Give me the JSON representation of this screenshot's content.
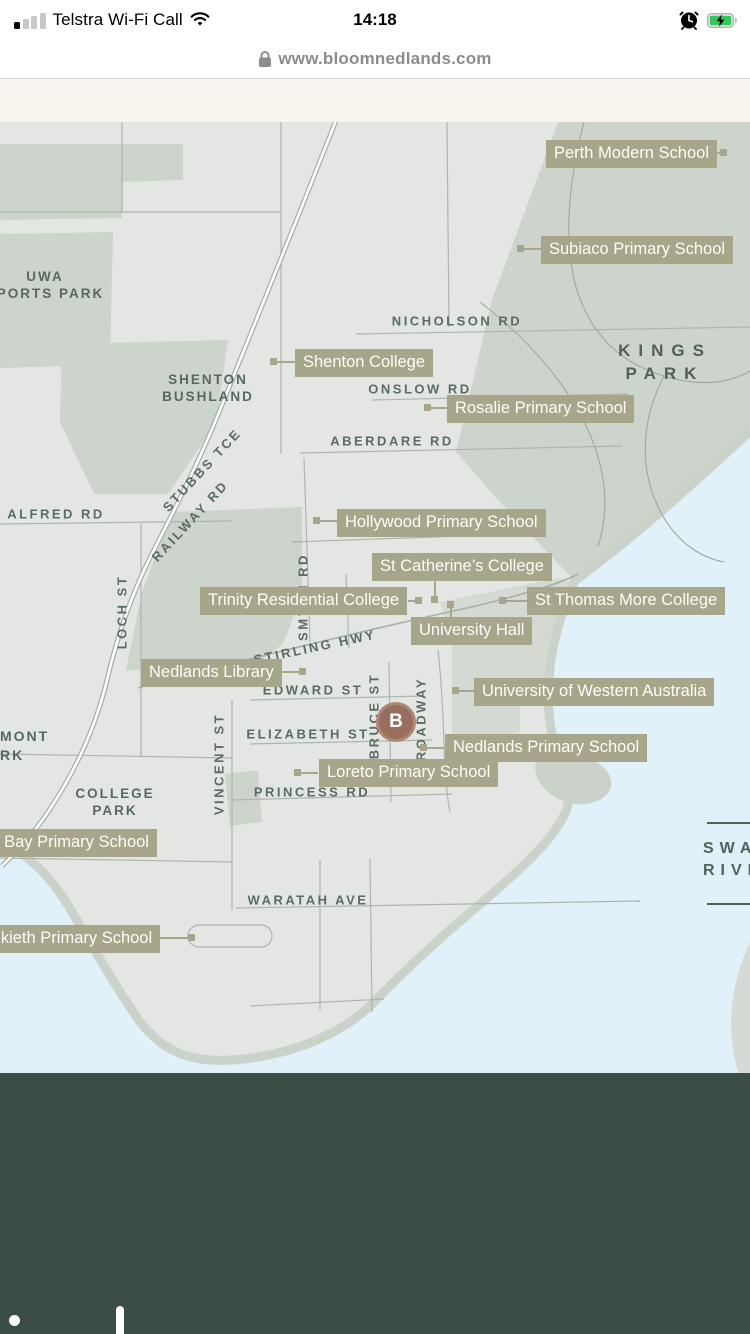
{
  "status_bar": {
    "carrier": "Telstra Wi-Fi Call",
    "time": "14:18"
  },
  "url_bar": {
    "url": "www.bloomnedlands.com"
  },
  "map": {
    "marker_b": "B",
    "poi": [
      {
        "label": "Perth Modern School"
      },
      {
        "label": "Subiaco Primary School"
      },
      {
        "label": "Shenton College"
      },
      {
        "label": "Rosalie Primary School"
      },
      {
        "label": "Hollywood Primary School"
      },
      {
        "label": "St Catherine’s College"
      },
      {
        "label": "Trinity Residential College"
      },
      {
        "label": "St Thomas More College"
      },
      {
        "label": "University Hall"
      },
      {
        "label": "Nedlands Library"
      },
      {
        "label": "University of Western Australia"
      },
      {
        "label": "Nedlands Primary School"
      },
      {
        "label": "Loreto Primary School"
      },
      {
        "label": "r Bay Primary School"
      },
      {
        "label": "alkieth Primary School"
      }
    ],
    "streets": {
      "nicholson": "NICHOLSON RD",
      "onslow": "ONSLOW RD",
      "aberdare": "ABERDARE RD",
      "alfred": "ALFRED RD",
      "edward": "EDWARD ST",
      "elizabeth": "ELIZABETH ST",
      "princess": "PRINCESS RD",
      "waratah": "WARATAH AVE",
      "loch": "LOCH ST",
      "vincent": "VINCENT ST",
      "bruce": "BRUCE ST",
      "broadway": "BROADWAY",
      "smyth": "SMYTH RD",
      "stubbs": "STUBBS TCE",
      "railway": "RAILWAY RD",
      "stirling": "STIRLING HWY"
    },
    "areas": {
      "uwa_line1": "UWA",
      "uwa_line2": "SPORTS PARK",
      "shenton_line1": "SHENTON",
      "shenton_line2": "BUSHLAND",
      "kings_line1": "KINGS",
      "kings_line2": "PARK",
      "college_line1": "COLLEGE",
      "college_line2": "PARK",
      "clipped_line1": "MONT",
      "clipped_line2": "RK",
      "river_line1": "SWAN",
      "river_line2": "RIVER"
    },
    "colors": {
      "label_accent": "#a7a58a",
      "water": "#e0f1f9",
      "park": "#cdd4cb",
      "footer": "#3c4d45",
      "marker": "#9a6e5e",
      "street_text": "#5a6c64"
    }
  },
  "footer": {}
}
